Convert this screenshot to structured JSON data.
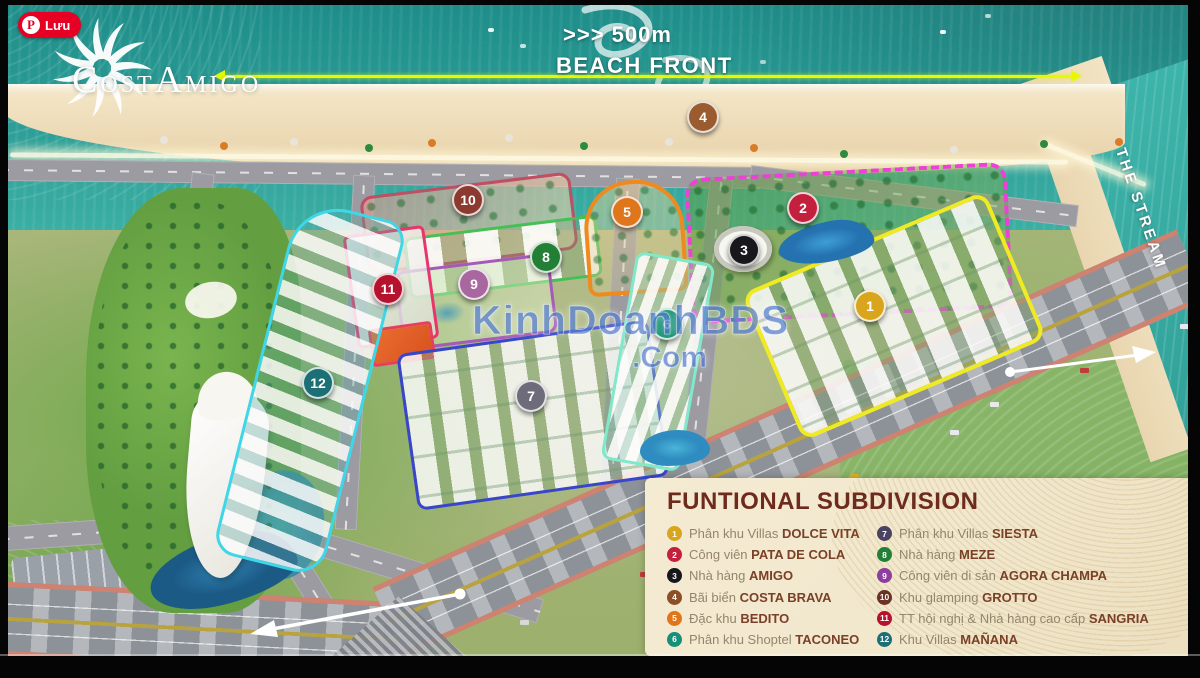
{
  "save_button": {
    "label": "Lưu",
    "icon": "pinterest-logo"
  },
  "logo": {
    "c1": "C",
    "rest1": "OST",
    "c2": "A",
    "rest2": "MIGO"
  },
  "beach_front": {
    "distance": ">>> 500m",
    "label": "BEACH FRONT"
  },
  "stream": {
    "label": "THE STREAM"
  },
  "watermark": {
    "line1": "KinhDoanhBĐS",
    "line2": ".Com"
  },
  "legend": {
    "title": "FUNTIONAL SUBDIVISION",
    "col1": [
      {
        "num": 1,
        "prefix": "Phân khu Villas",
        "name": "DOLCE VITA",
        "color": "#d9a51c"
      },
      {
        "num": 2,
        "prefix": "Công viên",
        "name": "PATA DE COLA",
        "color": "#c2203d"
      },
      {
        "num": 3,
        "prefix": "Nhà hàng",
        "name": "AMIGO",
        "color": "#17171c"
      },
      {
        "num": 4,
        "prefix": "Bãi biển",
        "name": "COSTA BRAVA",
        "color": "#8c4f28"
      },
      {
        "num": 5,
        "prefix": "Đặc khu",
        "name": "BEDITO",
        "color": "#e0761c"
      },
      {
        "num": 6,
        "prefix": "Phân khu Shoptel",
        "name": "TACONEO",
        "color": "#169076"
      }
    ],
    "col2": [
      {
        "num": 7,
        "prefix": "Phân khu Villas",
        "name": "SIESTA",
        "color": "#4a4462"
      },
      {
        "num": 8,
        "prefix": "Nhà hàng",
        "name": "MEZE",
        "color": "#237f36"
      },
      {
        "num": 9,
        "prefix": "Công viên di sản",
        "name": "AGORA CHAMPA",
        "color": "#8e3e9e"
      },
      {
        "num": 10,
        "prefix": "Khu glamping",
        "name": "GROTTO",
        "color": "#6b3226"
      },
      {
        "num": 11,
        "prefix": "TT hội nghị & Nhà hàng cao cấp",
        "name": "SANGRIA",
        "color": "#b5122e"
      },
      {
        "num": 12,
        "prefix": "Khu Villas",
        "name": "MAÑANA",
        "color": "#1c6f74"
      }
    ]
  },
  "map": {
    "markers": [
      {
        "num": 1,
        "x": 870,
        "y": 306,
        "color": "#d9a51c"
      },
      {
        "num": 2,
        "x": 803,
        "y": 208,
        "color": "#c2203d"
      },
      {
        "num": 3,
        "x": 744,
        "y": 250,
        "color": "#17171c"
      },
      {
        "num": 4,
        "x": 703,
        "y": 117,
        "color": "#9a5c2e"
      },
      {
        "num": 5,
        "x": 627,
        "y": 212,
        "color": "#e0761c"
      },
      {
        "num": 6,
        "x": 667,
        "y": 324,
        "color": "#169076"
      },
      {
        "num": 7,
        "x": 531,
        "y": 396,
        "color": "#6e6b7a"
      },
      {
        "num": 8,
        "x": 546,
        "y": 257,
        "color": "#237f36"
      },
      {
        "num": 9,
        "x": 474,
        "y": 284,
        "color": "#a8689f"
      },
      {
        "num": 10,
        "x": 468,
        "y": 200,
        "color": "#8c3a30"
      },
      {
        "num": 11,
        "x": 388,
        "y": 289,
        "color": "#b5122e"
      },
      {
        "num": 12,
        "x": 318,
        "y": 383,
        "color": "#1c6f74"
      }
    ]
  }
}
